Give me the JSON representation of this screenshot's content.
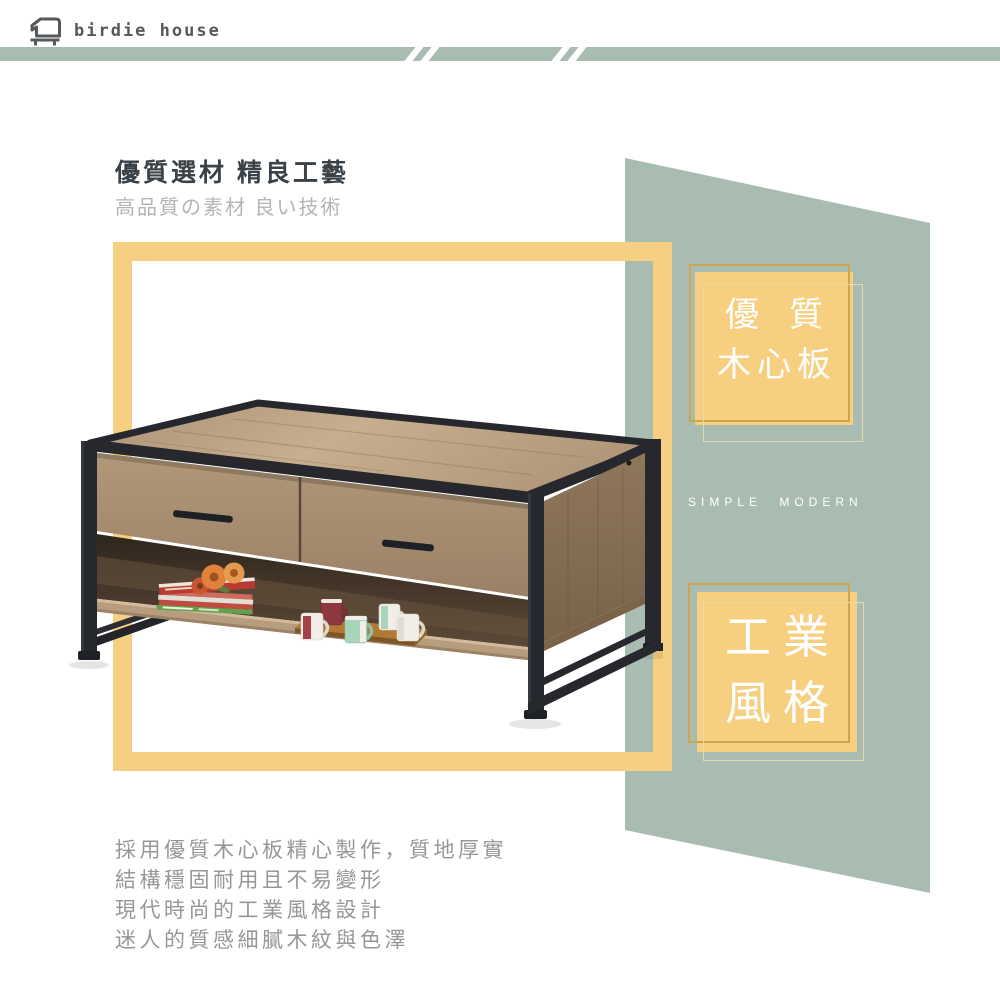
{
  "brand": {
    "name": "birdie house"
  },
  "icons": {
    "brand_logo": "birdhouse-furniture-outline-icon",
    "divider": "double-slash-stripes"
  },
  "headline": {
    "title": "優質選材 精良工藝",
    "subtitle": "高品質の素材 良い技術"
  },
  "badges": [
    {
      "id": "wood-core-board",
      "line1": "優質",
      "line2": "木心板"
    },
    {
      "id": "industrial-style",
      "line1": "工業",
      "line2": "風格"
    }
  ],
  "tagline": "SIMPLE MODERN",
  "description": {
    "lines": [
      "採用優質木心板精心製作，質地厚實",
      "結構穩固耐用且不易變形",
      "現代時尚的工業風格設計",
      "迷人的質感細膩木紋與色澤"
    ]
  },
  "colors": {
    "sage": "#a9bcb2",
    "yellow": "#f7cf82",
    "gold_outline": "#cfa44e",
    "heading_text": "#3a4147",
    "subtitle_text": "#b4b4b6",
    "body_text": "#97979b",
    "logo_gray": "#55595c",
    "badge_text": "#ffffff",
    "metal_black": "#26282d",
    "wood_top": "#b99f81",
    "wood_side": "#8d7456"
  }
}
